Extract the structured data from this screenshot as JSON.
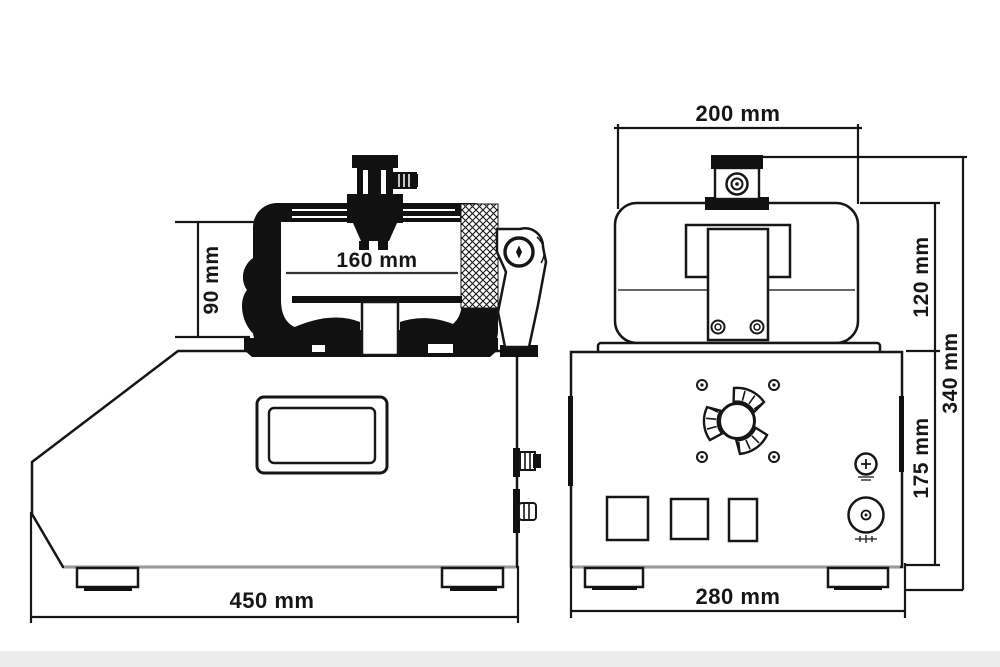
{
  "page": {
    "background": "#ffffff",
    "footer_strip_color": "#ececec"
  },
  "drawing": {
    "line_color": "#161616",
    "type": "technical dimension drawing of mug heat press machine, side and front views",
    "views": {
      "side": {
        "dims": {
          "opening_height": "90 mm",
          "opening_width": "160 mm",
          "overall_width": "450 mm"
        }
      },
      "front": {
        "dims": {
          "head_width": "200 mm",
          "head_height": "120 mm",
          "overall_height": "340 mm",
          "base_height": "175 mm",
          "base_width": "280 mm"
        }
      }
    }
  }
}
